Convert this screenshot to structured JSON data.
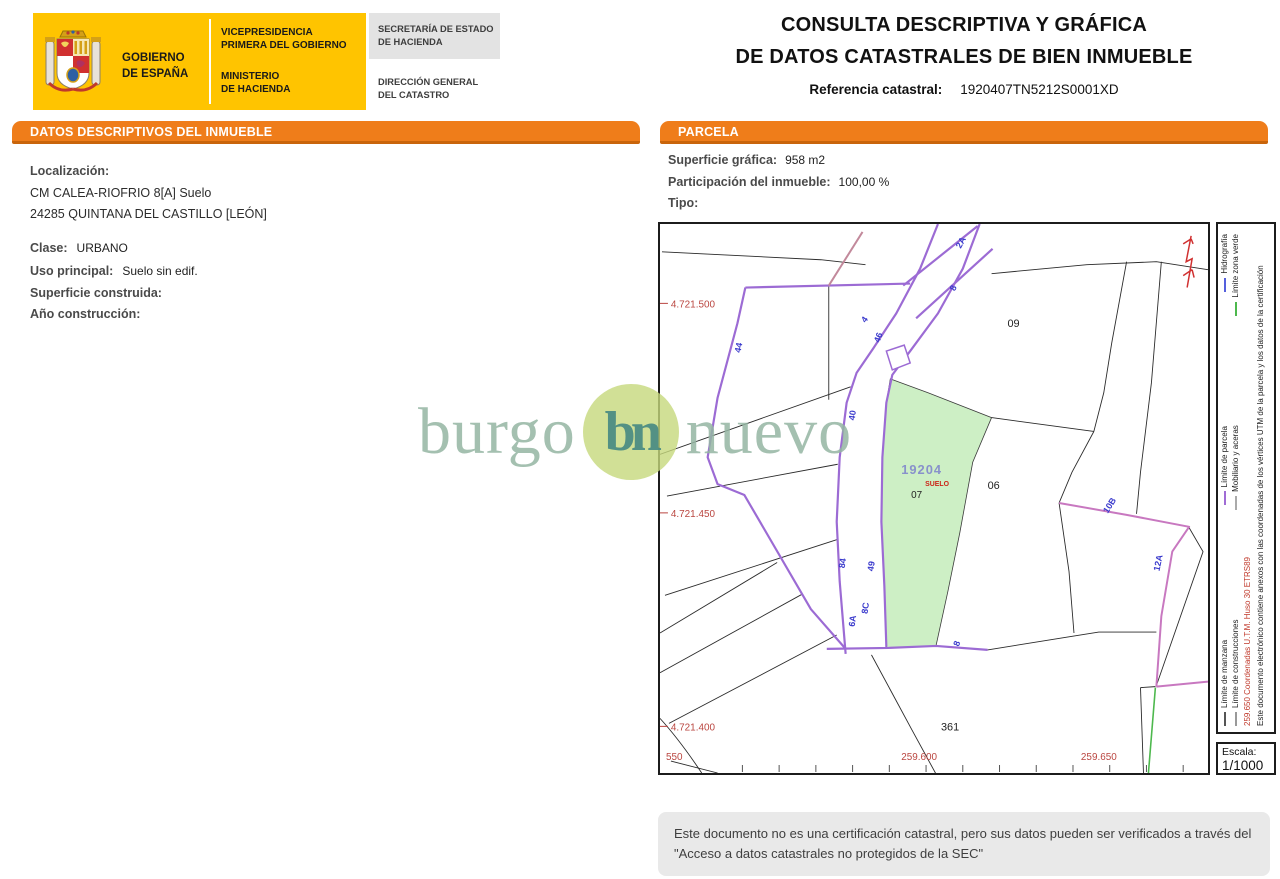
{
  "header": {
    "gobierno_line1": "GOBIERNO",
    "gobierno_line2": "DE ESPAÑA",
    "vicepresidencia_line1": "VICEPRESIDENCIA",
    "vicepresidencia_line2": "PRIMERA DEL GOBIERNO",
    "ministerio_line1": "MINISTERIO",
    "ministerio_line2": "DE HACIENDA",
    "secretaria_line1": "SECRETARÍA DE ESTADO",
    "secretaria_line2": "DE HACIENDA",
    "direccion_line1": "DIRECCIÓN GENERAL",
    "direccion_line2": "DEL CATASTRO"
  },
  "title": {
    "line1": "CONSULTA DESCRIPTIVA Y GRÁFICA",
    "line2": "DE DATOS CATASTRALES DE BIEN INMUEBLE",
    "ref_label": "Referencia catastral:",
    "ref_value": "1920407TN5212S0001XD"
  },
  "datos": {
    "header": "DATOS DESCRIPTIVOS DEL INMUEBLE",
    "localizacion_label": "Localización:",
    "address_line1": "CM CALEA-RIOFRIO 8[A] Suelo",
    "address_line2": "24285 QUINTANA DEL CASTILLO [LEÓN]",
    "clase_label": "Clase:",
    "clase_value": "URBANO",
    "uso_label": "Uso principal:",
    "uso_value": "Suelo sin edif.",
    "superficie_label": "Superficie construida:",
    "superficie_value": "",
    "anio_label": "Año construcción:",
    "anio_value": ""
  },
  "parcela": {
    "header": "PARCELA",
    "superficie_label": "Superficie gráfica:",
    "superficie_value": "958 m2",
    "participacion_label": "Participación del inmueble:",
    "participacion_value": "100,00 %",
    "tipo_label": "Tipo:",
    "tipo_value": ""
  },
  "map": {
    "parcel_labels": {
      "p09": "09",
      "p06": "06",
      "p07": "07",
      "p361": "361"
    },
    "subject": {
      "ref": "19204",
      "use": "SUELO"
    },
    "street_numbers": {
      "n2a": "2A",
      "n8": "8",
      "n4": "4",
      "n46": "46",
      "n44": "44",
      "n40": "40",
      "n84": "84",
      "n49": "49",
      "n8c": "8C",
      "n6a": "6A",
      "n8b": "8",
      "n10b": "10B",
      "n12a": "12A"
    },
    "coords_y": {
      "y1": "4.721.500",
      "y2": "4.721.450",
      "y3": "4.721.400"
    },
    "coords_x": {
      "x1": "550",
      "x2": "259.600",
      "x3": "259.650"
    },
    "colors": {
      "parcel_fill": "#CDEFC5",
      "limite_parcela": "#9C6BD4",
      "limite_pink": "#C878C0",
      "hidrografia": "#5560DD",
      "zona_verde": "#4DB84D",
      "coord_red": "#BA4640",
      "street_blue": "#3A3ACC"
    }
  },
  "legend": {
    "row1": [
      {
        "label": "Límite de manzana",
        "color": "#555555"
      },
      {
        "label": "Límite de parcela",
        "color": "#A06CD5"
      },
      {
        "label": "Hidrografía",
        "color": "#5560DD"
      }
    ],
    "row2": [
      {
        "label": "Límite de construcciones",
        "color": "#999999"
      },
      {
        "label": "Mobiliario y aceras",
        "color": "#aaaaaa"
      },
      {
        "label": "Límite zona verde",
        "color": "#4DB84D"
      }
    ],
    "coordinates_note": "259.650 Coordenadas U.T.M. Huso 30 ETRS89",
    "electronic_note": "Este documento electrónico contiene anexos con las coordenadas de los vértices UTM de la parcela y los datos de la certificación",
    "escala_label": "Escala:",
    "escala_value": "1/1000"
  },
  "watermark": {
    "part1": "burgo",
    "monogram": "bn",
    "part2": "nuevo"
  },
  "footer": {
    "disclaimer": "Este documento no es una certificación catastral, pero sus datos pueden ser verificados a través del \"Acceso a datos catastrales no protegidos de la SEC\""
  }
}
